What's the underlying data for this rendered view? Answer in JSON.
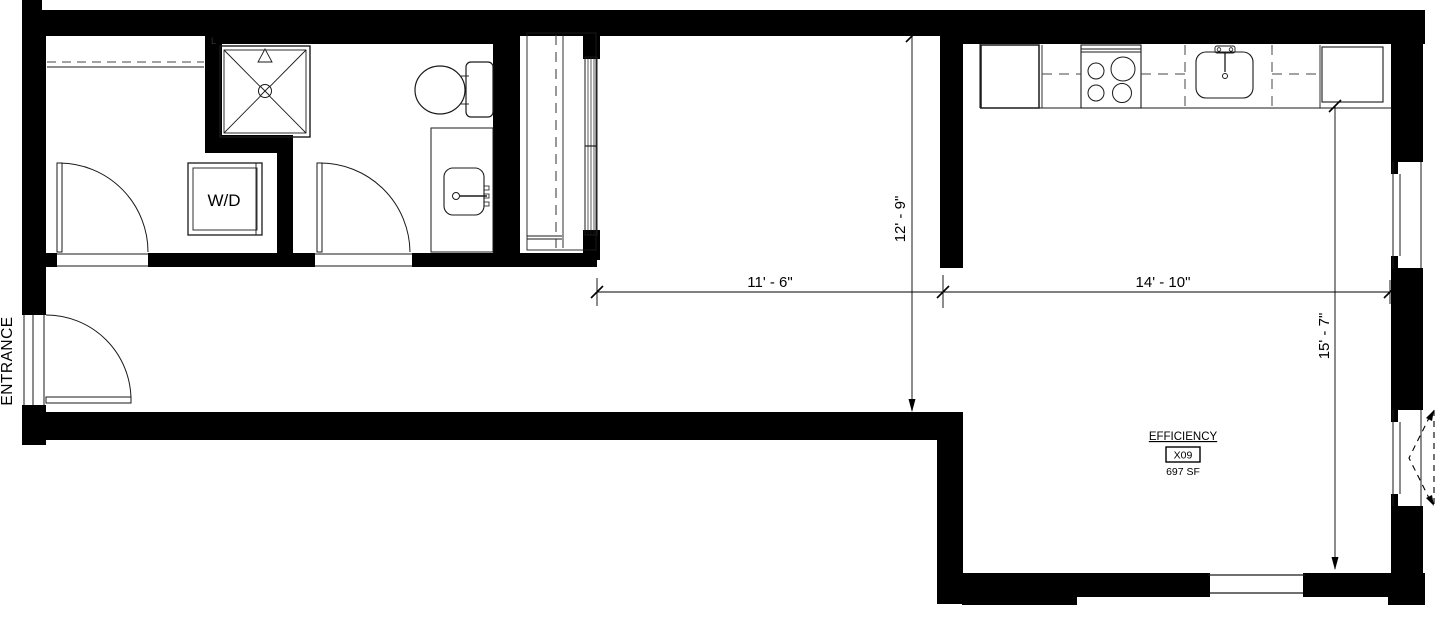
{
  "labels": {
    "entrance": "ENTRANCE",
    "washer_dryer": "W/D",
    "room_name": "EFFICIENCY",
    "unit_number": "X09",
    "unit_area": "697 SF",
    "corner_tag": "L"
  },
  "dimensions": {
    "bedroom_width": "11' - 6\"",
    "bedroom_depth": "12' - 9\"",
    "living_width": "14' - 10\"",
    "living_depth": "15' - 7\""
  },
  "colors": {
    "wall": "#000000",
    "background": "#ffffff",
    "line": "#1a1a1a",
    "dashed": "#444444"
  }
}
